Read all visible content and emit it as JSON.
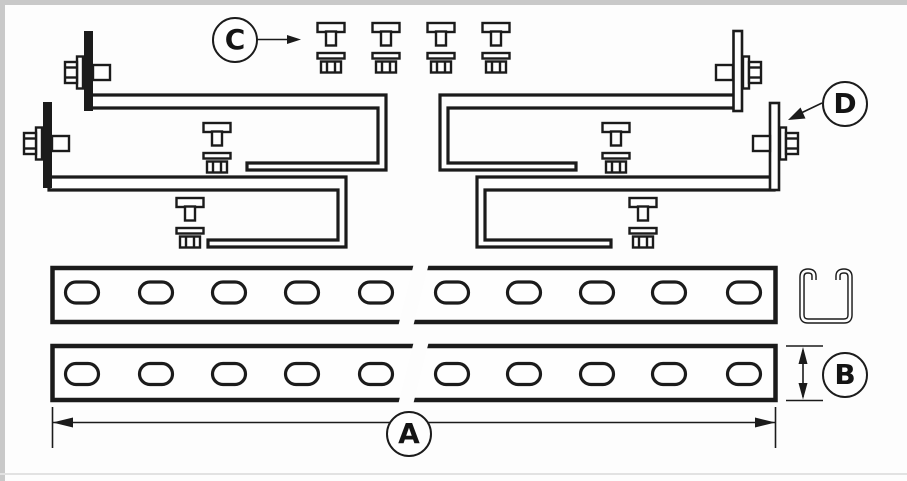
{
  "page": {
    "kind": "technical line drawing of strut channel mounting kit parts",
    "colors": {
      "ink": "#1b1b1b",
      "paper": "#fdfdfd",
      "frame_gray": "#c9c9c9",
      "bottom_rule": "#e2e2e2"
    },
    "counts": {
      "step_brackets": 4,
      "flange_hex_bolts": 4,
      "loose_t_bolts_top_row": 4,
      "t_bolts_on_brackets": 4,
      "slotted_rails": 2,
      "slots_per_rail": 10,
      "cross_sections": 1
    }
  },
  "callouts": {
    "a": "A",
    "b": "B",
    "c": "C",
    "d": "D"
  }
}
